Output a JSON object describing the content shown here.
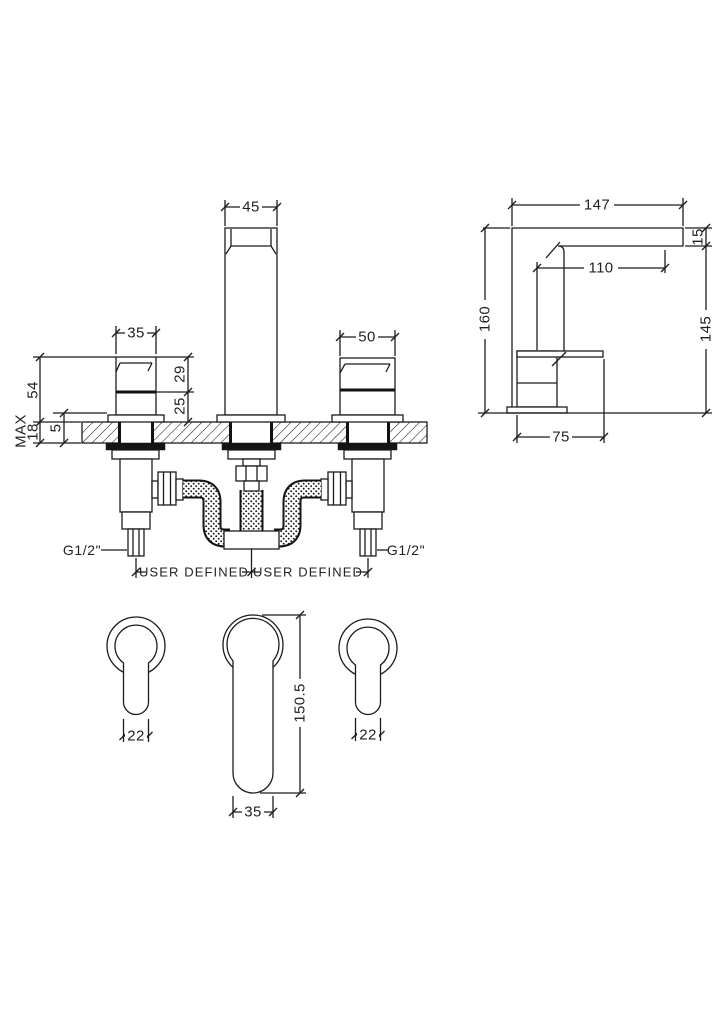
{
  "front": {
    "dim_spout_width": "45",
    "dim_left_handle_width": "35",
    "dim_right_handle_width": "50",
    "dim_height_above_deck": "54",
    "label_max": "MAX",
    "dim_deck_max": "18",
    "dim_flange": "5",
    "dim_handle_upper": "29",
    "dim_handle_lower": "25",
    "label_thread_left": "G1/2\"",
    "label_thread_right": "G1/2\"",
    "label_hose_left": "USER DEFINED",
    "label_hose_right": "USER DEFINED"
  },
  "side": {
    "dim_reach": "147",
    "dim_spout_thickness": "15",
    "dim_projection": "110",
    "dim_height": "160",
    "dim_underspout": "145",
    "dim_base": "75"
  },
  "plan": {
    "dim_left_handle": "22",
    "dim_right_handle": "22",
    "dim_spout_length": "150.5",
    "dim_spout_width": "35"
  },
  "colors": {
    "line": "#1c1c1c",
    "background": "#ffffff"
  }
}
